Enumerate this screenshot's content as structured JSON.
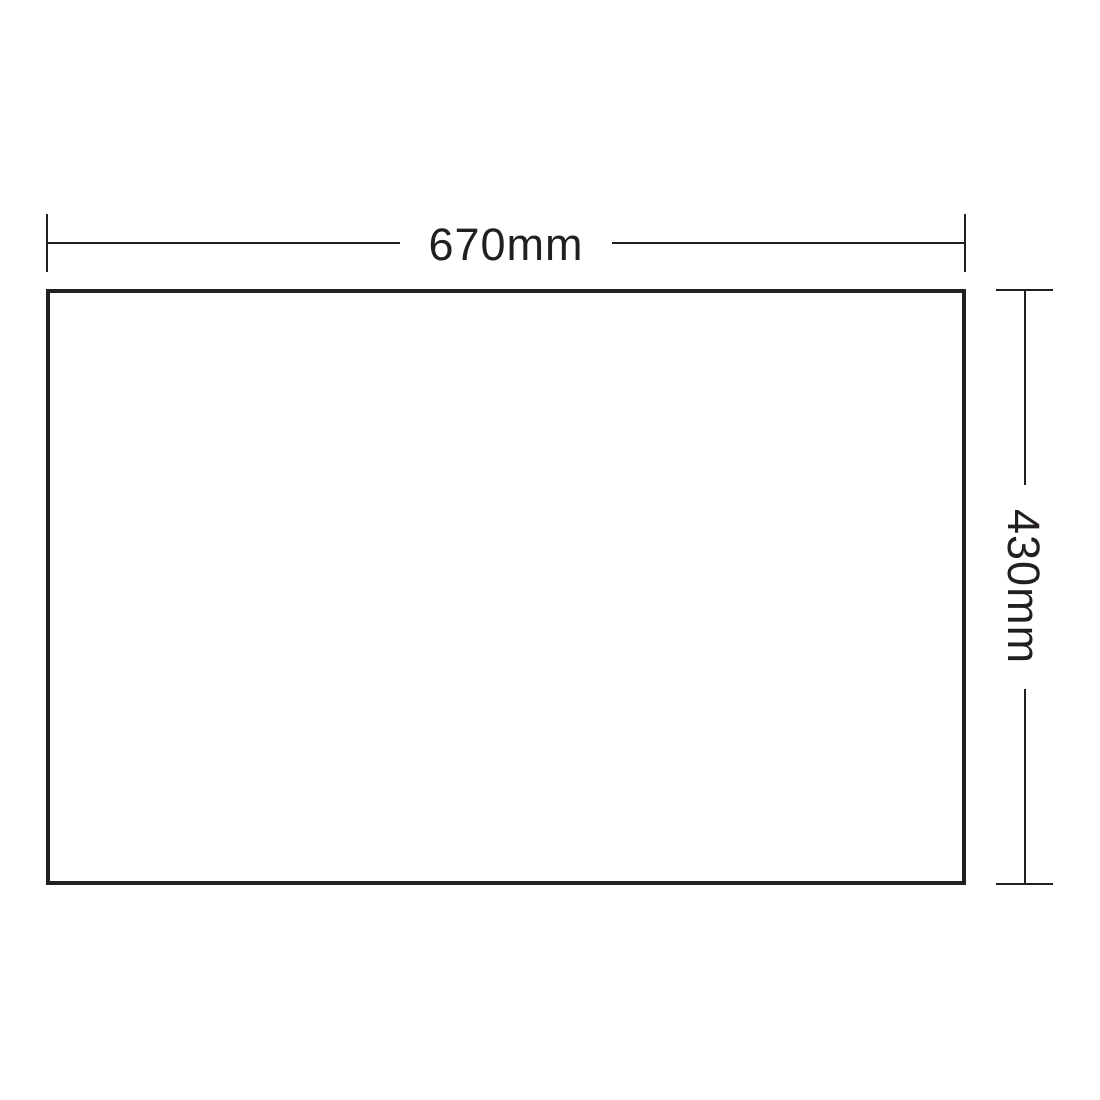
{
  "colors": {
    "ink": "#231f20",
    "bg": "#ffffff"
  },
  "diagram": {
    "type": "rectangle-dimension-drawing",
    "width_label": "670mm",
    "height_label": "430mm"
  }
}
